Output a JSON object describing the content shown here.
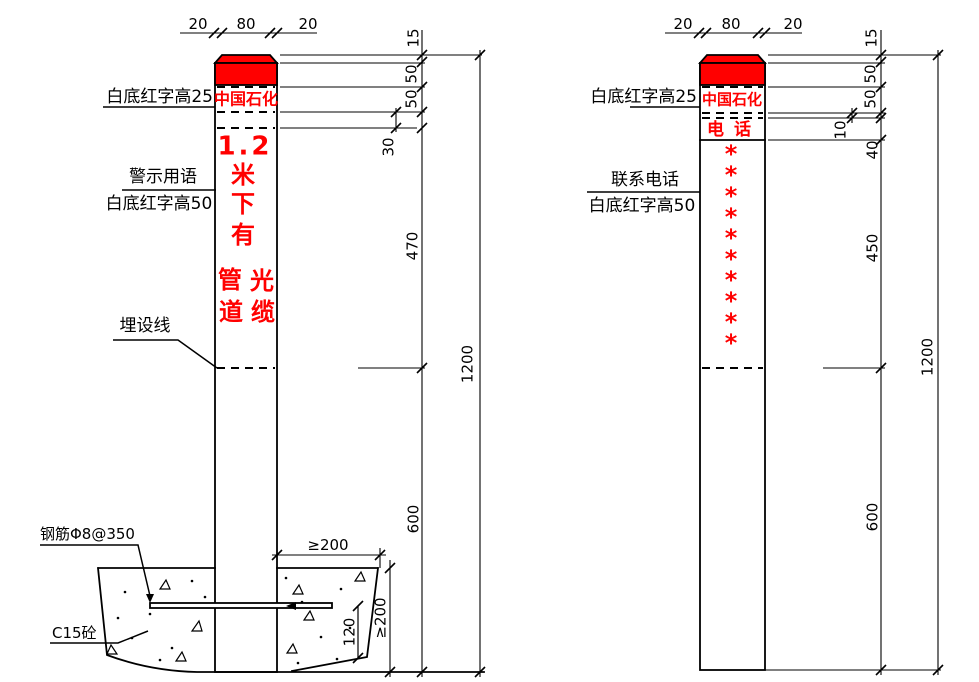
{
  "colors": {
    "accent_red": "#ff0000",
    "line_black": "#000000",
    "paper_white": "#ffffff"
  },
  "left_post": {
    "top_dims": [
      "20",
      "80",
      "20"
    ],
    "cap_label": "白底红字高25",
    "brand": "中国石化",
    "warning_title": "警示用语",
    "warning_subtitle": "白底红字高50",
    "warning_chars": [
      "1.2",
      "米",
      "下",
      "有",
      "管",
      "光",
      "道",
      "缆"
    ],
    "burial_label": "埋设线",
    "rebar_label": "钢筋Φ8@350",
    "concrete_label": "C15砼",
    "side_dims": [
      "15",
      "50",
      "50",
      "30",
      "470",
      "600"
    ],
    "total_dim": "1200",
    "foundation_dims": {
      "width": "≥200",
      "depth": "≥200",
      "edge": "120"
    }
  },
  "right_post": {
    "top_dims": [
      "20",
      "80",
      "20"
    ],
    "cap_label": "白底红字高25",
    "brand": "中国石化",
    "phone_title": "电 话",
    "contact_label": "联系电话",
    "contact_subtitle": "白底红字高50",
    "stars": [
      "*",
      "*",
      "*",
      "*",
      "*",
      "*",
      "*",
      "*",
      "*",
      "*"
    ],
    "side_dims": [
      "15",
      "50",
      "50",
      "10",
      "40",
      "450",
      "600"
    ],
    "total_dim": "1200"
  }
}
